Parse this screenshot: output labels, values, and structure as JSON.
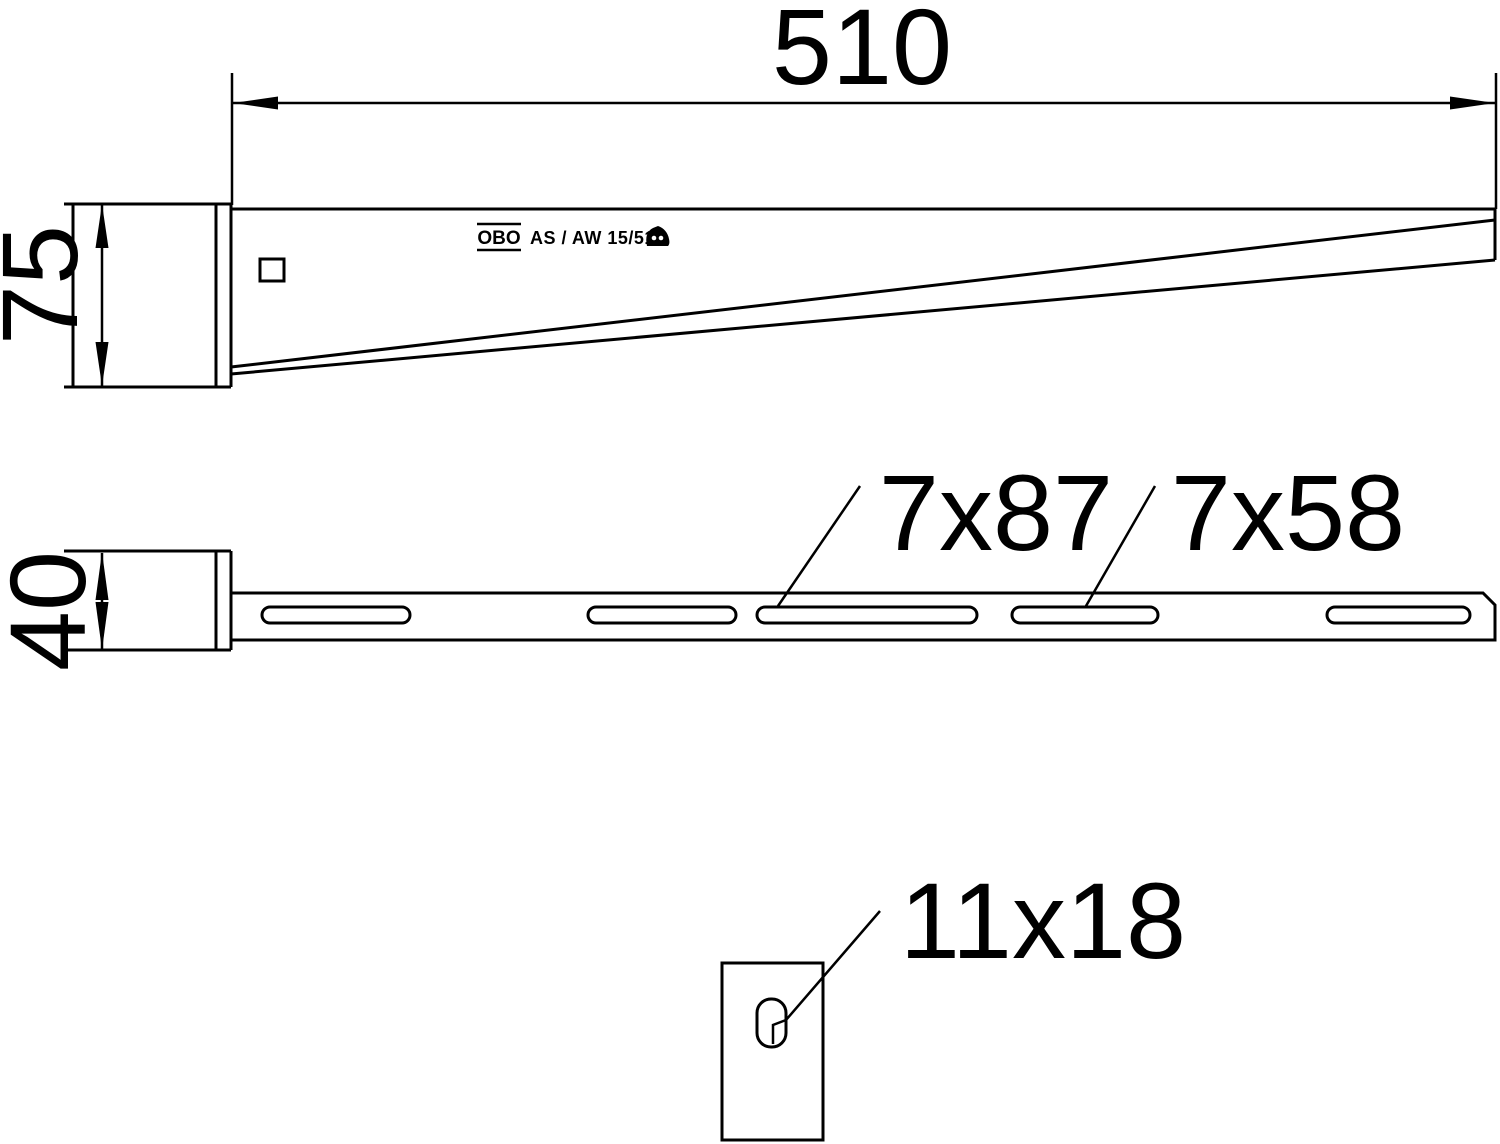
{
  "colors": {
    "background": "#ffffff",
    "line": "#000000"
  },
  "side_view": {
    "length_dim": "510",
    "height_dim": "75",
    "brand": "OBO",
    "model": "AS / AW 15/51"
  },
  "top_view": {
    "width_dim": "40",
    "long_slot_label": "7x87",
    "short_slot_label": "7x58"
  },
  "detail_view": {
    "hole_label": "11x18"
  }
}
